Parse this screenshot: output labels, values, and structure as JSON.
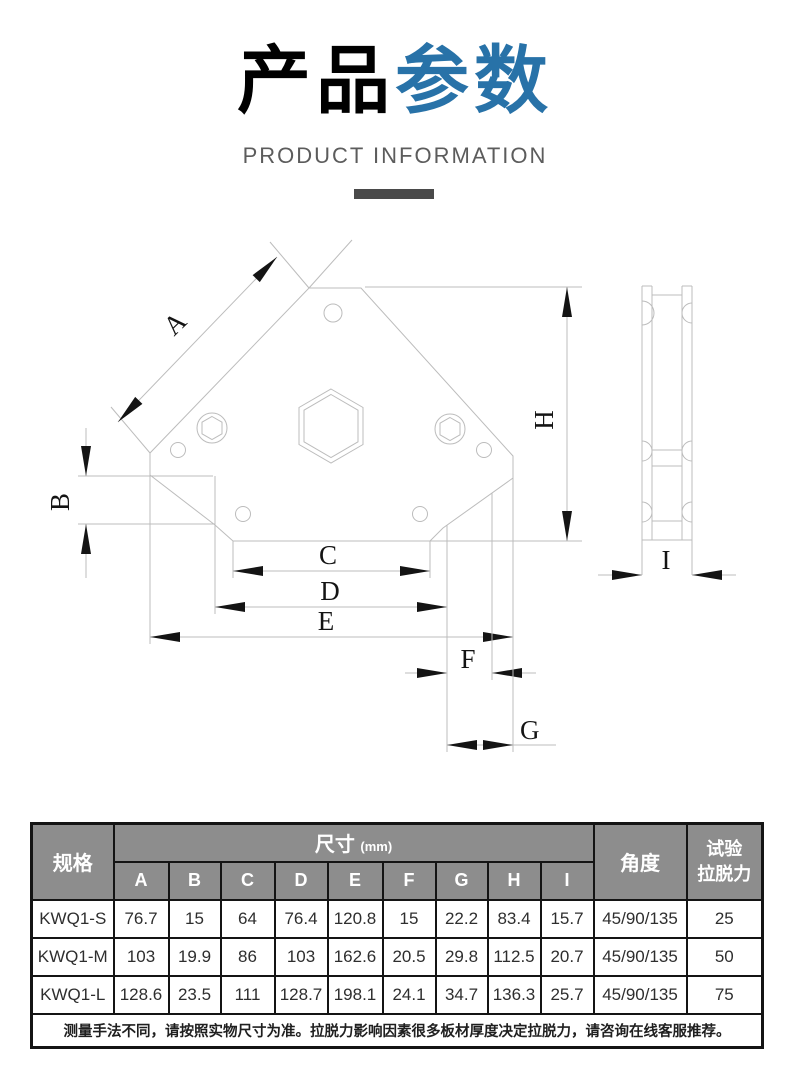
{
  "header": {
    "title_black": "产品",
    "title_blue": "参数",
    "subtitle": "PRODUCT INFORMATION"
  },
  "colors": {
    "title_accent_blue": "#2872a8",
    "title_dark": "#3d3d3d",
    "table_header_gray": "#8d8d8d",
    "table_border": "#141414",
    "drawing_line_gray": "#bcbcbc"
  },
  "diagram": {
    "dimension_labels": {
      "a": "A",
      "b": "B",
      "c": "C",
      "d": "D",
      "e": "E",
      "f": "F",
      "g": "G",
      "h": "H",
      "i": "I"
    }
  },
  "table": {
    "spec_header": "规格",
    "size_header": "尺寸",
    "size_unit": "(mm)",
    "angle_header": "角度",
    "pull_header_line1": "试验",
    "pull_header_line2": "拉脱力",
    "col_letters": [
      "A",
      "B",
      "C",
      "D",
      "E",
      "F",
      "G",
      "H",
      "I"
    ],
    "rows": [
      {
        "spec": "KWQ1-S",
        "values": [
          "76.7",
          "15",
          "64",
          "76.4",
          "120.8",
          "15",
          "22.2",
          "83.4",
          "15.7"
        ],
        "angle": "45/90/135",
        "pull": "25"
      },
      {
        "spec": "KWQ1-M",
        "values": [
          "103",
          "19.9",
          "86",
          "103",
          "162.6",
          "20.5",
          "29.8",
          "112.5",
          "20.7"
        ],
        "angle": "45/90/135",
        "pull": "50"
      },
      {
        "spec": "KWQ1-L",
        "values": [
          "128.6",
          "23.5",
          "111",
          "128.7",
          "198.1",
          "24.1",
          "34.7",
          "136.3",
          "25.7"
        ],
        "angle": "45/90/135",
        "pull": "75"
      }
    ],
    "note": "测量手法不同，请按照实物尺寸为准。拉脱力影响因素很多板材厚度决定拉脱力，请咨询在线客服推荐。"
  }
}
